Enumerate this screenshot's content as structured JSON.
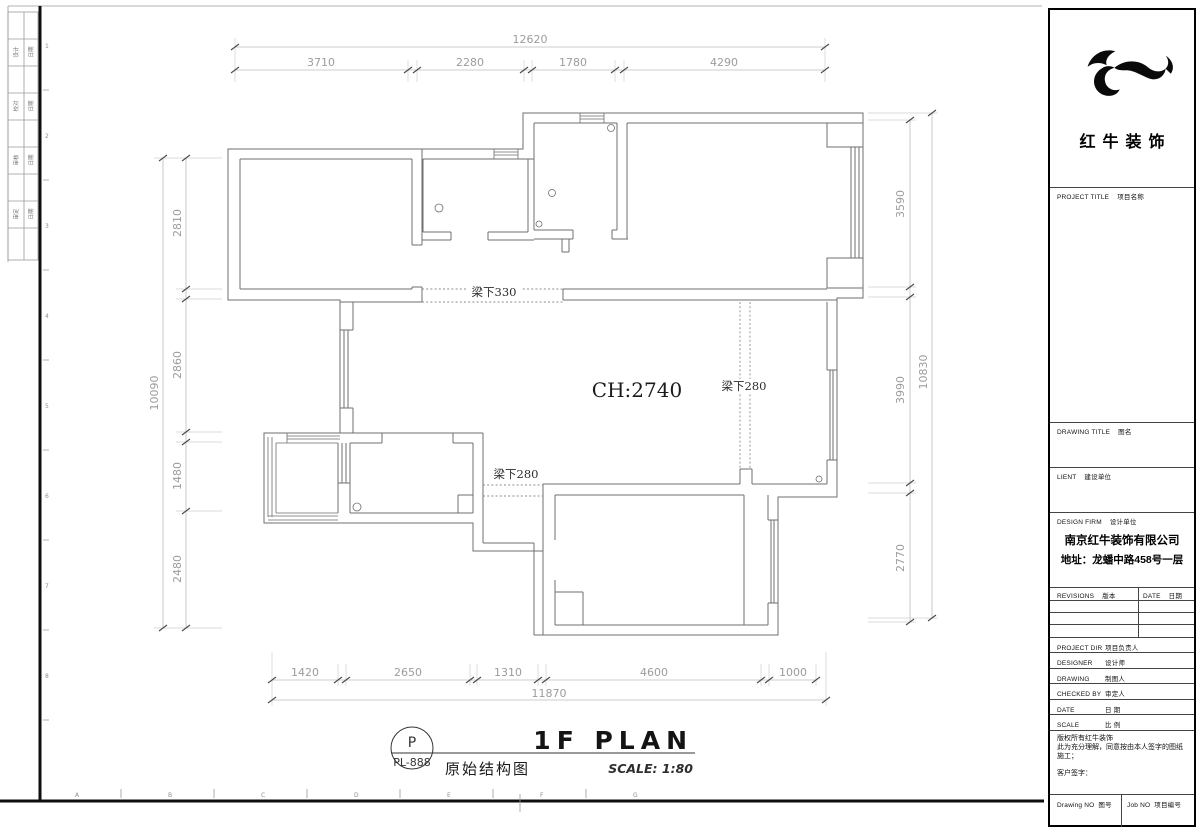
{
  "dims": {
    "top": {
      "total": "12620",
      "seg": [
        "3710",
        "2280",
        "1780",
        "4290"
      ]
    },
    "left": {
      "total": "10090",
      "seg": [
        "2810",
        "2860",
        "1480",
        "2480"
      ]
    },
    "right": {
      "total": "10830",
      "seg": [
        "3590",
        "3990",
        "2770"
      ]
    },
    "bottom": {
      "total": "11870",
      "seg": [
        "1420",
        "2650",
        "1310",
        "4600",
        "1000"
      ]
    }
  },
  "plan": {
    "ch": "CH:2740",
    "beam330": "梁下330",
    "beam280a": "梁下280",
    "beam280b": "梁下280"
  },
  "title": {
    "code": "P",
    "sheet": "PL-888",
    "main": "1F PLAN",
    "cn": "原始结构图",
    "scale": "SCALE: 1:80"
  },
  "frame": {
    "rows": [
      "1",
      "2",
      "3",
      "4",
      "5",
      "6",
      "7",
      "8"
    ],
    "cols": [
      "A",
      "B",
      "C",
      "D",
      "E",
      "F",
      "G"
    ],
    "stamps": [
      {
        "l": "设计",
        "r": "日期"
      },
      {
        "l": "校对",
        "r": "日期"
      },
      {
        "l": "审核",
        "r": "日期"
      },
      {
        "l": "审定",
        "r": "日期"
      }
    ]
  },
  "sidebar": {
    "brand": "红牛装饰",
    "project_title": {
      "en": "PROJECT TITLE",
      "cn": "项目名称"
    },
    "drawing_title": {
      "en": "DRAWING TITLE",
      "cn": "图名"
    },
    "client": {
      "en": "LIENT",
      "cn": "建设单位"
    },
    "design_firm": {
      "en": "DESIGN FIRM",
      "cn": "设计单位"
    },
    "firm_name": "南京红牛装饰有限公司",
    "firm_addr": "地址：龙蟠中路458号一层",
    "revisions": {
      "en": "REVISIONS",
      "cn": "版本"
    },
    "rev_date": {
      "en": "DATE",
      "cn": "日期"
    },
    "fields": [
      {
        "en": "PROJECT DIR",
        "cn": "项目负责人"
      },
      {
        "en": "DESIGNER",
        "cn": "设计师"
      },
      {
        "en": "DRAWING",
        "cn": "制图人"
      },
      {
        "en": "CHECKED BY",
        "cn": "审定人"
      },
      {
        "en": "DATE",
        "cn": "日 期"
      },
      {
        "en": "SCALE",
        "cn": "比 例"
      }
    ],
    "notes": [
      "版权所有红牛装饰",
      "此为充分理解，同意按由本人签字的图纸施工；",
      "客户签字："
    ],
    "drawing_no": {
      "en": "Drawing NO",
      "cn": "图号"
    },
    "job_no": {
      "en": "Job NO",
      "cn": "项目编号"
    },
    "colors": {
      "logo": "#0a0a0a",
      "line": "#444444"
    }
  }
}
